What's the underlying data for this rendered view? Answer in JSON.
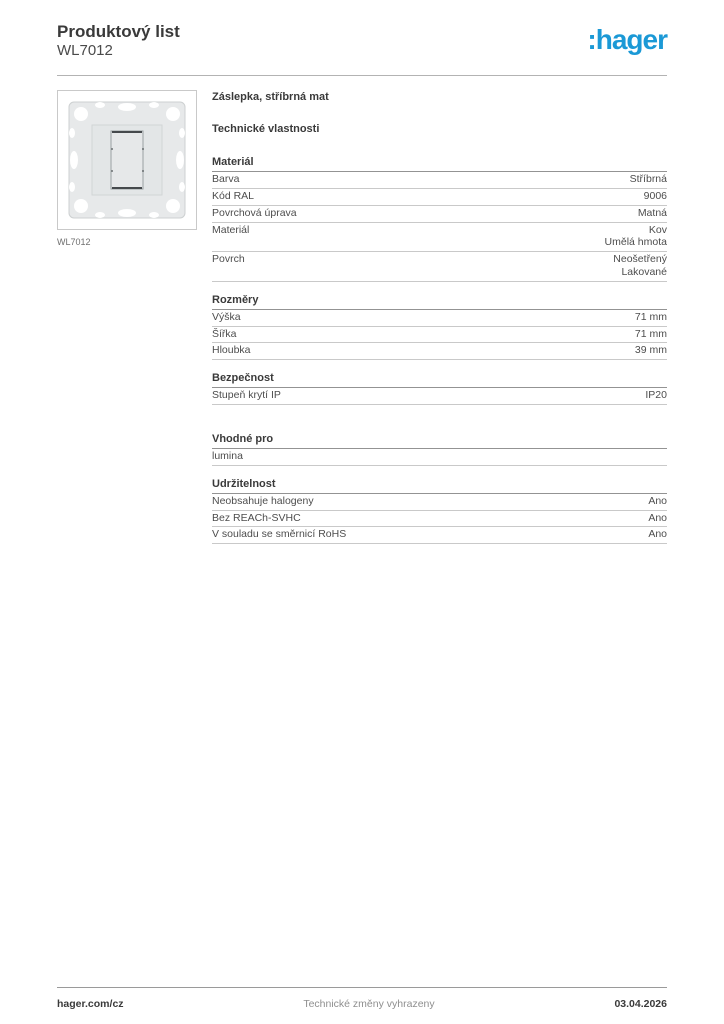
{
  "header": {
    "title": "Produktový list",
    "subtitle": "WL7012",
    "logo_text": ":hager",
    "logo_color": "#1b99d6"
  },
  "product": {
    "name": "Záslepka, stříbrná mat",
    "image_caption": "WL7012",
    "image_alt_icon": "blank-cover-plate-photo"
  },
  "technical_properties_title": "Technické vlastnosti",
  "sections": [
    {
      "title": "Materiál",
      "rows": [
        {
          "label": "Barva",
          "values": [
            "Stříbrná"
          ]
        },
        {
          "label": "Kód RAL",
          "values": [
            "9006"
          ]
        },
        {
          "label": "Povrchová úprava",
          "values": [
            "Matná"
          ]
        },
        {
          "label": "Materiál",
          "values": [
            "Kov",
            "Umělá hmota"
          ]
        },
        {
          "label": "Povrch",
          "values": [
            "Neošetřený",
            "Lakované"
          ]
        }
      ]
    },
    {
      "title": "Rozměry",
      "rows": [
        {
          "label": "Výška",
          "values": [
            "71 mm"
          ]
        },
        {
          "label": "Šířka",
          "values": [
            "71 mm"
          ]
        },
        {
          "label": "Hloubka",
          "values": [
            "39 mm"
          ]
        }
      ]
    },
    {
      "title": "Bezpečnost",
      "rows": [
        {
          "label": "Stupeň krytí IP",
          "values": [
            "IP20"
          ]
        }
      ]
    },
    {
      "title": "Vhodné pro",
      "rows": [
        {
          "label": "lumina",
          "values": []
        }
      ]
    },
    {
      "title": "Udržitelnost",
      "rows": [
        {
          "label": "Neobsahuje halogeny",
          "values": [
            "Ano"
          ]
        },
        {
          "label": "Bez REACh-SVHC",
          "values": [
            "Ano"
          ]
        },
        {
          "label": "V souladu se směrnicí RoHS",
          "values": [
            "Ano"
          ]
        }
      ]
    }
  ],
  "footer": {
    "website": "hager.com/cz",
    "disclaimer": "Technické změny vyhrazeny",
    "date": "03.04.2026"
  }
}
